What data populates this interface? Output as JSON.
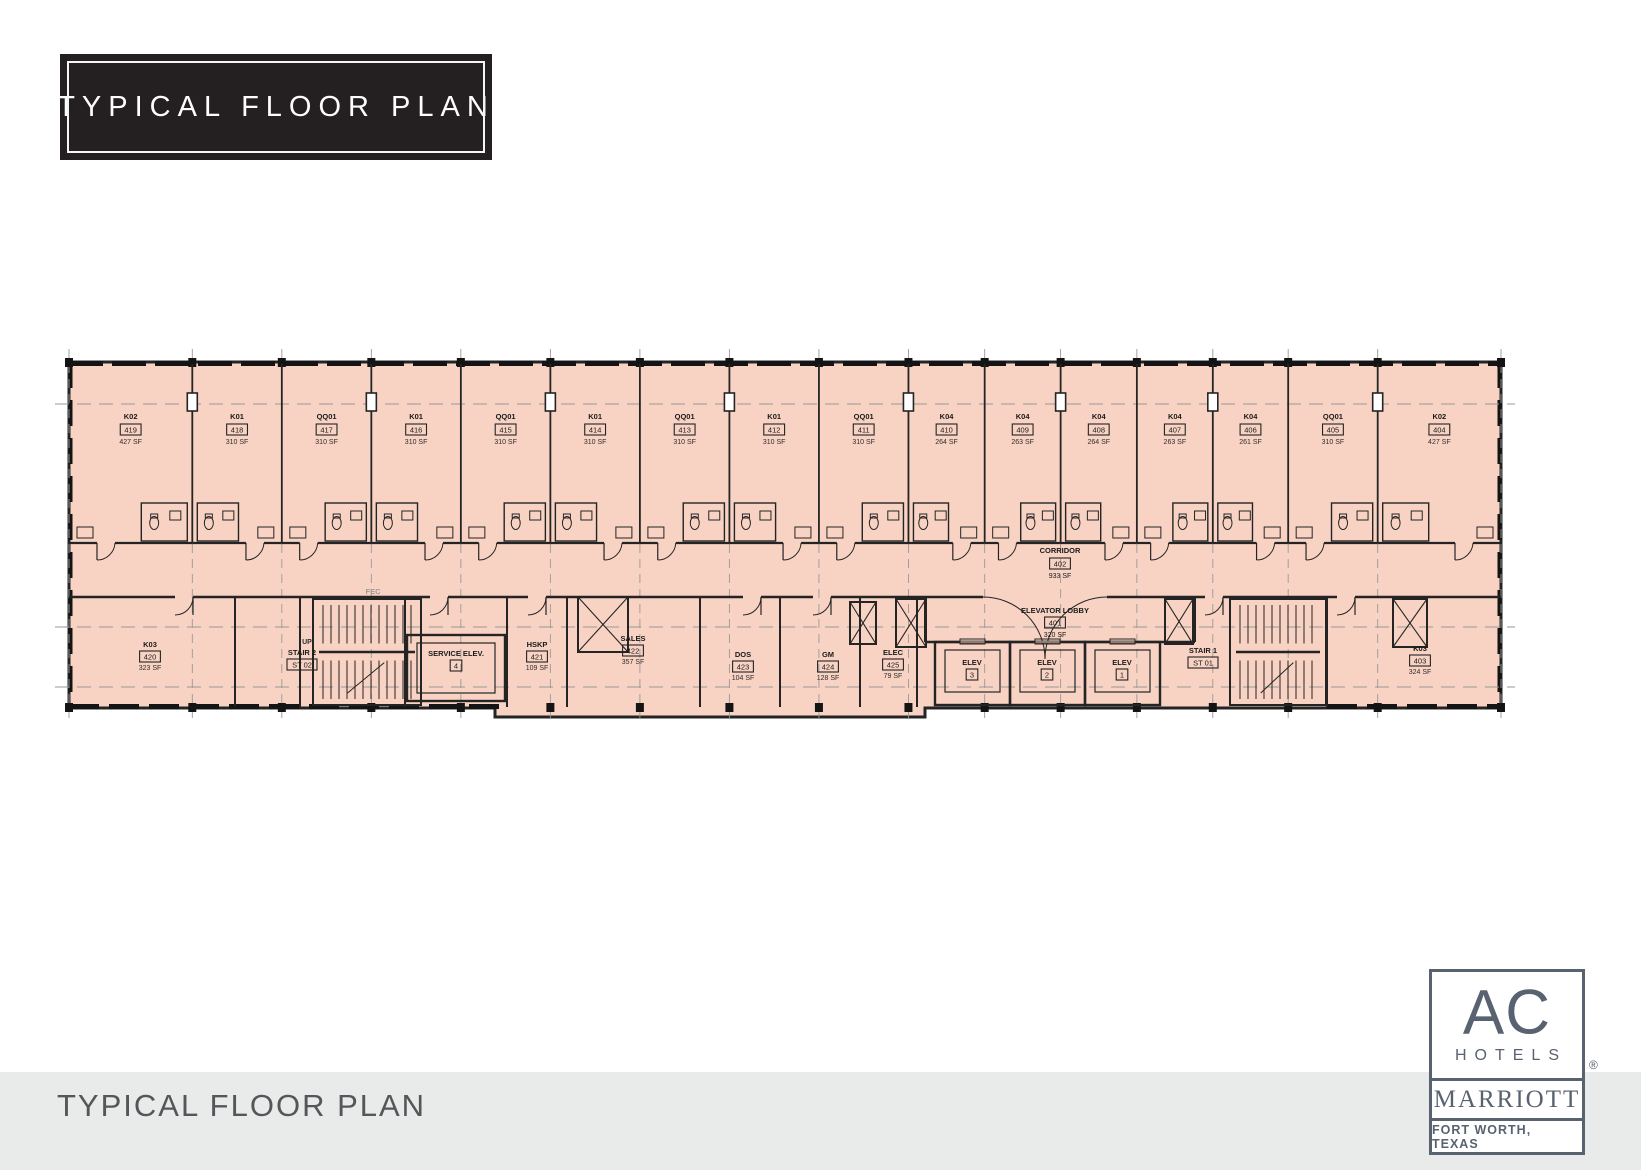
{
  "header": {
    "title": "TYPICAL FLOOR PLAN"
  },
  "footer": {
    "title": "TYPICAL FLOOR PLAN"
  },
  "logo": {
    "brand": "AC",
    "sub": "HOTELS",
    "parent": "MARRIOTT",
    "location": "FORT WORTH, TEXAS",
    "registered": "®"
  },
  "plan": {
    "colors": {
      "floor_fill": "#f8d3c3",
      "wall": "#242424",
      "grid": "#999999",
      "text": "#1a1a1a"
    },
    "corridor": {
      "name": "CORRIDOR",
      "num": "402",
      "sf": "933 SF"
    },
    "elevator_lobby": {
      "name": "ELEVATOR LOBBY",
      "num": "401",
      "sf": "320 SF"
    },
    "top_rooms": [
      {
        "type": "K02",
        "num": "419",
        "sf": "427 SF"
      },
      {
        "type": "K01",
        "num": "418",
        "sf": "310 SF"
      },
      {
        "type": "QQ01",
        "num": "417",
        "sf": "310 SF"
      },
      {
        "type": "K01",
        "num": "416",
        "sf": "310 SF"
      },
      {
        "type": "QQ01",
        "num": "415",
        "sf": "310 SF"
      },
      {
        "type": "K01",
        "num": "414",
        "sf": "310 SF"
      },
      {
        "type": "QQ01",
        "num": "413",
        "sf": "310 SF"
      },
      {
        "type": "K01",
        "num": "412",
        "sf": "310 SF"
      },
      {
        "type": "QQ01",
        "num": "411",
        "sf": "310 SF"
      },
      {
        "type": "K04",
        "num": "410",
        "sf": "264 SF"
      },
      {
        "type": "K04",
        "num": "409",
        "sf": "263 SF"
      },
      {
        "type": "K04",
        "num": "408",
        "sf": "264 SF"
      },
      {
        "type": "K04",
        "num": "407",
        "sf": "263 SF"
      },
      {
        "type": "K04",
        "num": "406",
        "sf": "261 SF"
      },
      {
        "type": "QQ01",
        "num": "405",
        "sf": "310 SF"
      },
      {
        "type": "K02",
        "num": "404",
        "sf": "427 SF"
      }
    ],
    "bottom_rooms": [
      {
        "name": "K03",
        "num": "420",
        "sf": "323 SF"
      },
      {
        "name": "STAIR 2",
        "num": "ST 02",
        "sf": ""
      },
      {
        "name": "SERVICE ELEV.",
        "num": "4",
        "sf": ""
      },
      {
        "name": "HSKP",
        "num": "421",
        "sf": "109 SF"
      },
      {
        "name": "SALES",
        "num": "422",
        "sf": "357 SF"
      },
      {
        "name": "DOS",
        "num": "423",
        "sf": "104 SF"
      },
      {
        "name": "GM",
        "num": "424",
        "sf": "128 SF"
      },
      {
        "name": "ELEC",
        "num": "425",
        "sf": "79 SF"
      },
      {
        "name": "ELEV",
        "num": "3",
        "sf": ""
      },
      {
        "name": "ELEV",
        "num": "2",
        "sf": ""
      },
      {
        "name": "ELEV",
        "num": "1",
        "sf": ""
      },
      {
        "name": "STAIR 1",
        "num": "ST 01",
        "sf": ""
      },
      {
        "name": "K03",
        "num": "403",
        "sf": "324 SF"
      }
    ],
    "annotations": {
      "fec": "FEC",
      "up": "UP"
    }
  }
}
